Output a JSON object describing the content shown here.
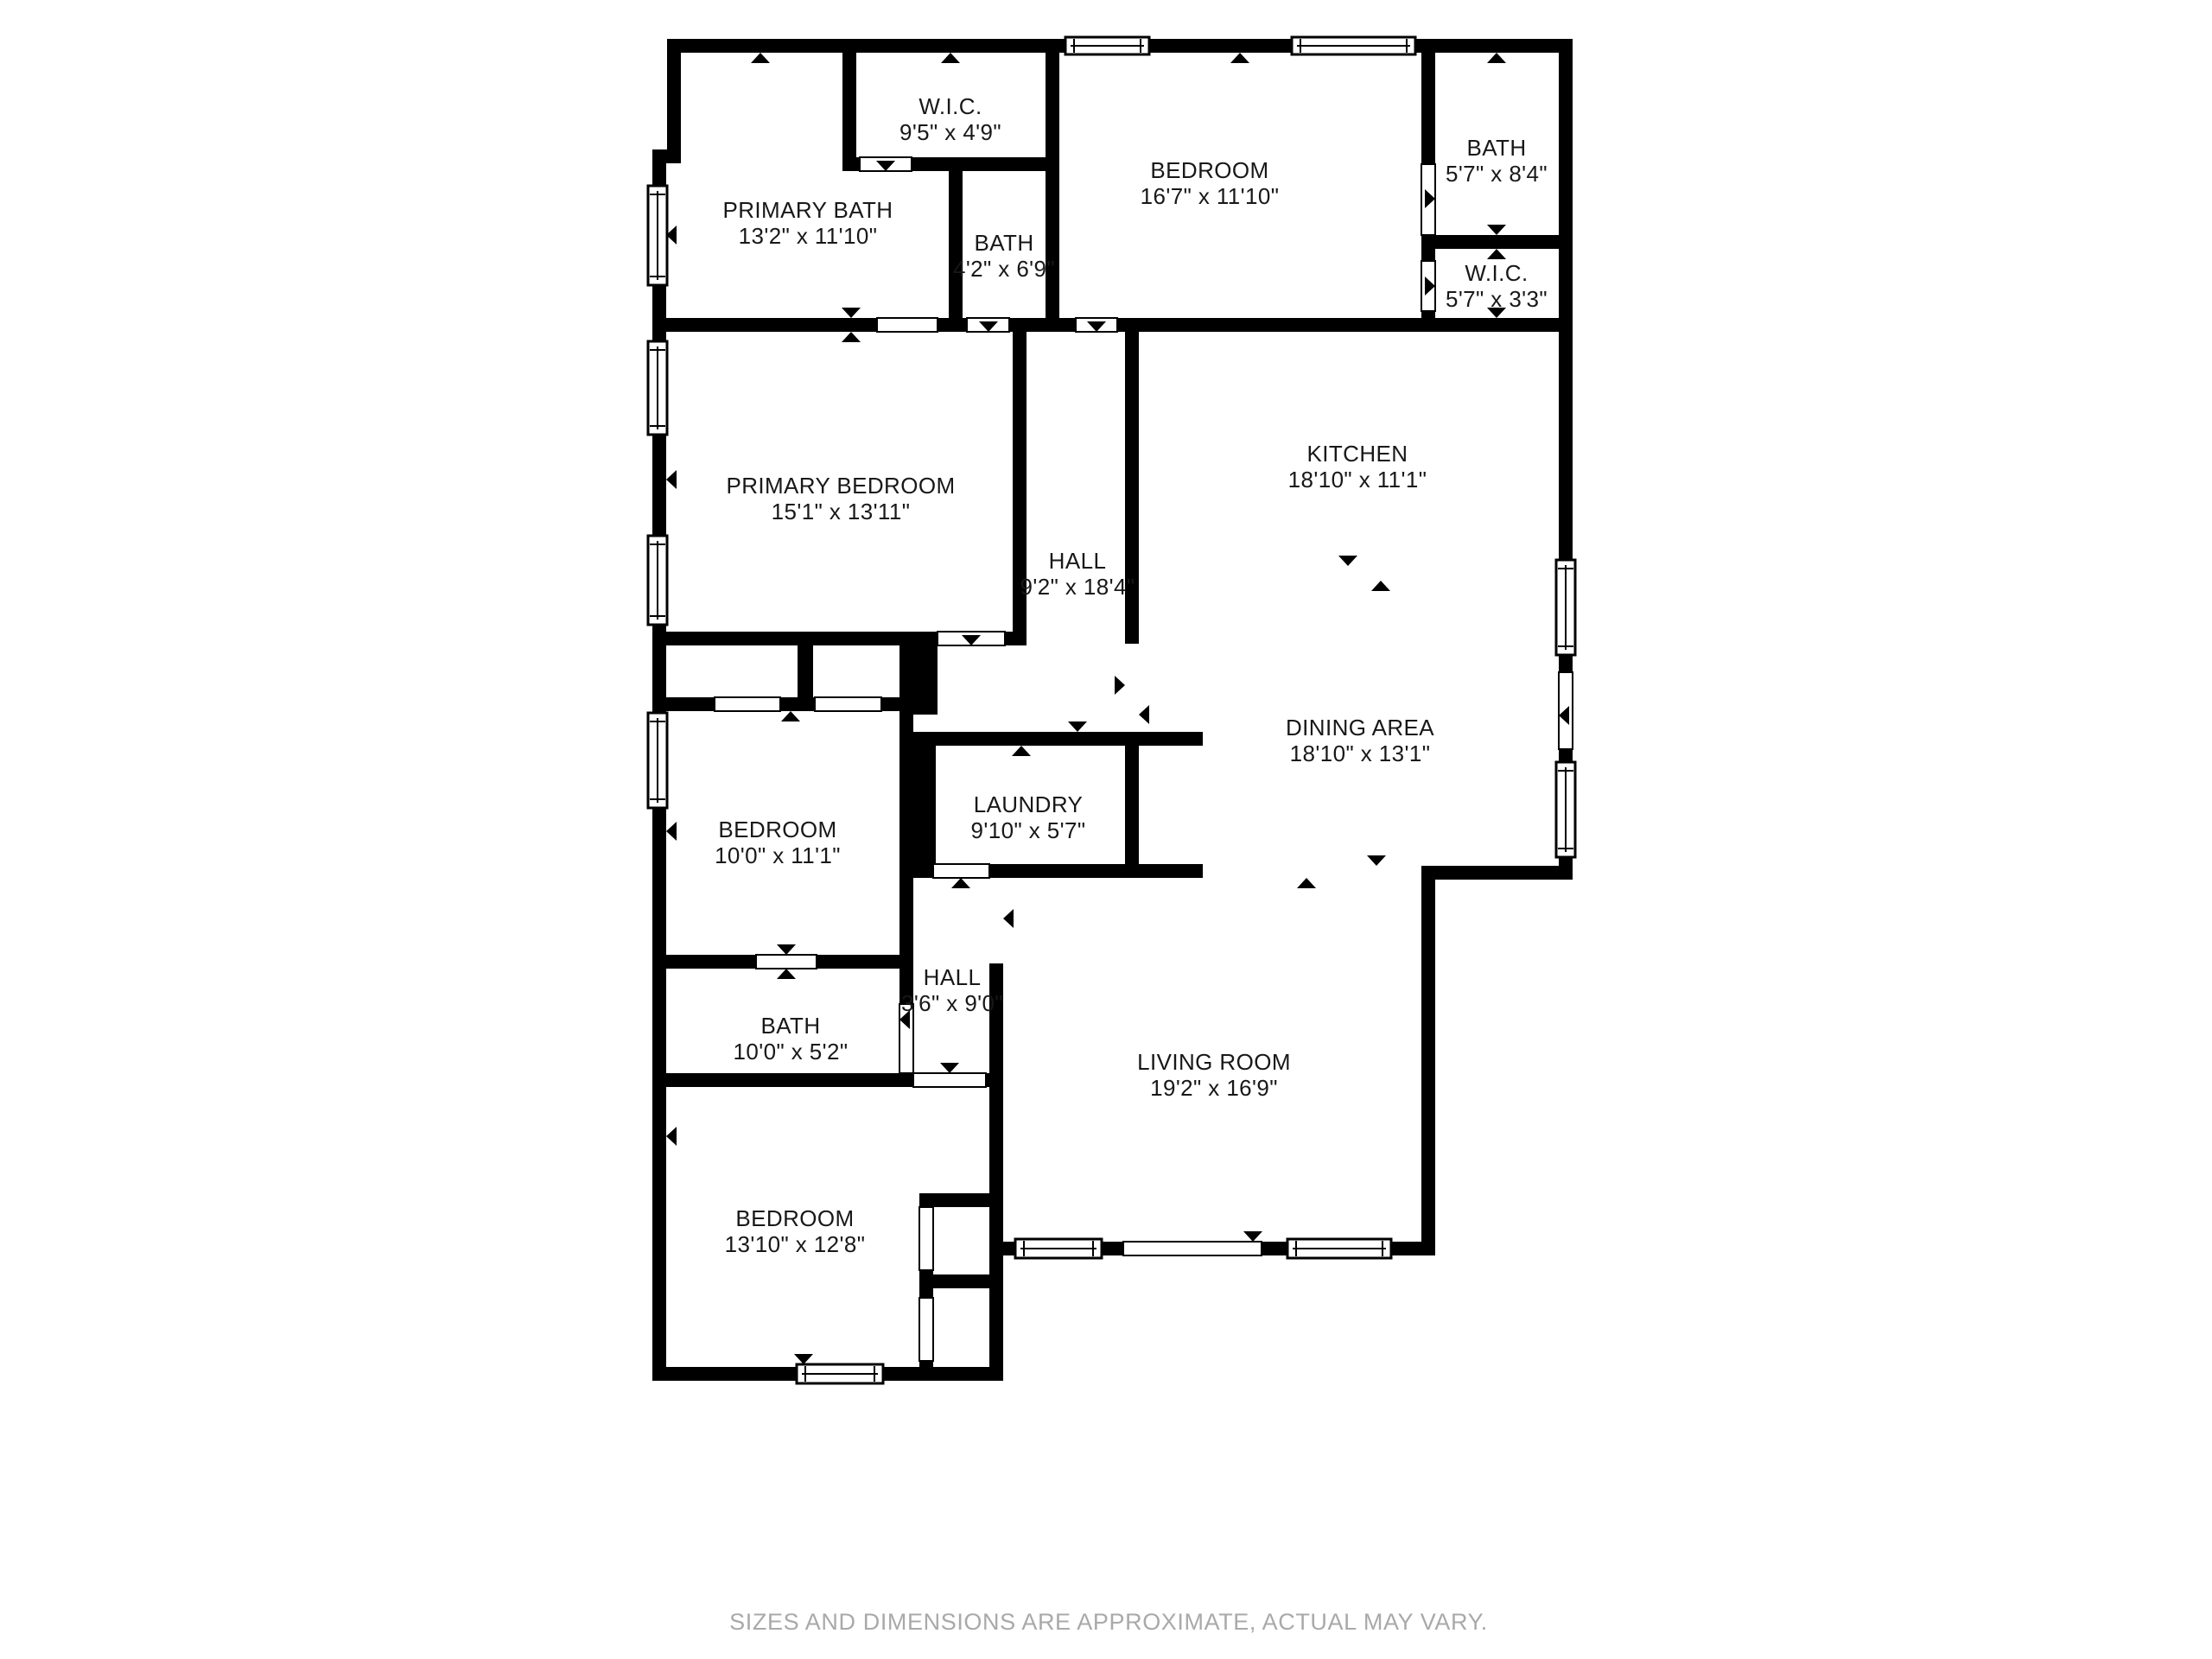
{
  "page": {
    "background": "#ffffff",
    "wall_color": "#000000",
    "label_color": "#181818",
    "footer": "SIZES AND DIMENSIONS ARE APPROXIMATE, ACTUAL MAY VARY.",
    "footer_color": "#a9a9a9"
  },
  "rooms": [
    {
      "id": "primary-bath",
      "name": "PRIMARY BATH",
      "dims": "13'2\" x 11'10\""
    },
    {
      "id": "wic-top",
      "name": "W.I.C.",
      "dims": "9'5\" x 4'9\""
    },
    {
      "id": "bath-top",
      "name": "BATH",
      "dims": "4'2\" x 6'9\""
    },
    {
      "id": "bedroom-top",
      "name": "BEDROOM",
      "dims": "16'7\" x 11'10\""
    },
    {
      "id": "bath-right",
      "name": "BATH",
      "dims": "5'7\" x 8'4\""
    },
    {
      "id": "wic-right",
      "name": "W.I.C.",
      "dims": "5'7\" x 3'3\""
    },
    {
      "id": "primary-bedroom",
      "name": "PRIMARY BEDROOM",
      "dims": "15'1\" x 13'11\""
    },
    {
      "id": "hall",
      "name": "HALL",
      "dims": "9'2\" x 18'4\""
    },
    {
      "id": "kitchen",
      "name": "KITCHEN",
      "dims": "18'10\" x 11'1\""
    },
    {
      "id": "dining-area",
      "name": "DINING AREA",
      "dims": "18'10\" x 13'1\""
    },
    {
      "id": "bedroom-mid",
      "name": "BEDROOM",
      "dims": "10'0\" x 11'1\""
    },
    {
      "id": "laundry",
      "name": "LAUNDRY",
      "dims": "9'10\" x 5'7\""
    },
    {
      "id": "hall-small",
      "name": "HALL",
      "dims": "3'6\" x 9'0\""
    },
    {
      "id": "bath-mid",
      "name": "BATH",
      "dims": "10'0\" x 5'2\""
    },
    {
      "id": "living-room",
      "name": "LIVING ROOM",
      "dims": "19'2\" x 16'9\""
    },
    {
      "id": "bedroom-bottom",
      "name": "BEDROOM",
      "dims": "13'10\" x 12'8\""
    }
  ]
}
